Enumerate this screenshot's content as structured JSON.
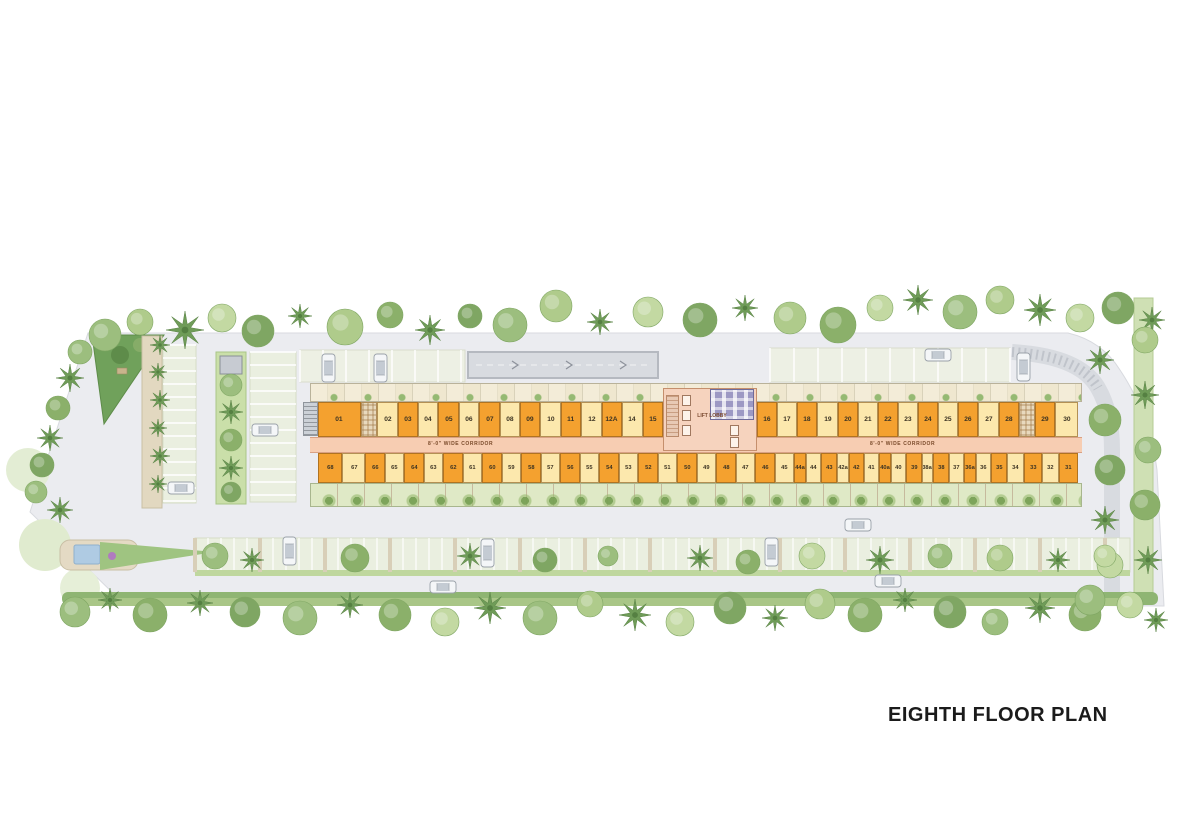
{
  "title": "EIGHTH FLOOR PLAN",
  "palette": {
    "unit_orange": "#f4a12f",
    "unit_cream": "#fce8ad",
    "corridor_pink": "#f7cdb2",
    "lobby_pink": "#f6d3be",
    "toilet_purple": "#9d99c4",
    "pavement_gray": "#ebecf0",
    "landscape_green": "#9cbe7e"
  },
  "building": {
    "corridor_label_left": "8'-0\" WIDE CORRIDOR",
    "corridor_label_right": "8'-0\" WIDE CORRIDOR",
    "lobby_label": "LIFT LOBBY",
    "top_left_units": [
      {
        "no": "01",
        "c": "o",
        "w": 2.2
      },
      {
        "t": "a"
      },
      {
        "no": "02",
        "c": "c"
      },
      {
        "no": "03",
        "c": "o"
      },
      {
        "no": "04",
        "c": "c"
      },
      {
        "no": "05",
        "c": "o"
      },
      {
        "no": "06",
        "c": "c"
      },
      {
        "no": "07",
        "c": "o"
      },
      {
        "no": "08",
        "c": "c"
      },
      {
        "no": "09",
        "c": "o"
      },
      {
        "no": "10",
        "c": "c"
      },
      {
        "no": "11",
        "c": "o"
      },
      {
        "no": "12",
        "c": "c"
      },
      {
        "no": "12A",
        "c": "o"
      },
      {
        "no": "14",
        "c": "c"
      },
      {
        "no": "15",
        "c": "o"
      }
    ],
    "top_right_units": [
      {
        "no": "16",
        "c": "o"
      },
      {
        "no": "17",
        "c": "c"
      },
      {
        "no": "18",
        "c": "o"
      },
      {
        "no": "19",
        "c": "c"
      },
      {
        "no": "20",
        "c": "o"
      },
      {
        "no": "21",
        "c": "c"
      },
      {
        "no": "22",
        "c": "o"
      },
      {
        "no": "23",
        "c": "c"
      },
      {
        "no": "24",
        "c": "o"
      },
      {
        "no": "25",
        "c": "c"
      },
      {
        "no": "26",
        "c": "o"
      },
      {
        "no": "27",
        "c": "c"
      },
      {
        "no": "28",
        "c": "o"
      },
      {
        "t": "a"
      },
      {
        "no": "29",
        "c": "o"
      },
      {
        "no": "30",
        "c": "c",
        "w": 1.15
      }
    ],
    "bottom_units": [
      {
        "no": "68",
        "c": "o",
        "w": 1.6
      },
      {
        "no": "67",
        "c": "c",
        "w": 1.5
      },
      {
        "no": "66",
        "c": "o",
        "w": 1.25
      },
      {
        "no": "65",
        "c": "c",
        "w": 1.25
      },
      {
        "no": "64",
        "c": "o",
        "w": 1.25
      },
      {
        "no": "63",
        "c": "c",
        "w": 1.25
      },
      {
        "no": "62",
        "c": "o",
        "w": 1.25
      },
      {
        "no": "61",
        "c": "c",
        "w": 1.25
      },
      {
        "no": "60",
        "c": "o",
        "w": 1.25
      },
      {
        "no": "59",
        "c": "c",
        "w": 1.25
      },
      {
        "no": "58",
        "c": "o",
        "w": 1.25
      },
      {
        "no": "57",
        "c": "c",
        "w": 1.25
      },
      {
        "no": "56",
        "c": "o",
        "w": 1.25
      },
      {
        "no": "55",
        "c": "c",
        "w": 1.25
      },
      {
        "no": "54",
        "c": "o",
        "w": 1.25
      },
      {
        "no": "53",
        "c": "c",
        "w": 1.25
      },
      {
        "no": "52",
        "c": "o",
        "w": 1.25
      },
      {
        "no": "51",
        "c": "c",
        "w": 1.25
      },
      {
        "no": "50",
        "c": "o",
        "w": 1.25
      },
      {
        "no": "49",
        "c": "c",
        "w": 1.25
      },
      {
        "no": "48",
        "c": "o",
        "w": 1.25
      },
      {
        "no": "47",
        "c": "c",
        "w": 1.25
      },
      {
        "no": "46",
        "c": "o",
        "w": 1.25
      },
      {
        "no": "45",
        "c": "c",
        "w": 1.25
      },
      {
        "no": "44a",
        "c": "o",
        "w": 0.7
      },
      {
        "no": "44",
        "c": "c",
        "w": 0.95
      },
      {
        "no": "43",
        "c": "o",
        "w": 0.95
      },
      {
        "no": "42a",
        "c": "c",
        "w": 0.7
      },
      {
        "no": "42",
        "c": "o",
        "w": 0.95
      },
      {
        "no": "41",
        "c": "c",
        "w": 0.95
      },
      {
        "no": "40a",
        "c": "o",
        "w": 0.7
      },
      {
        "no": "40",
        "c": "c",
        "w": 0.95
      },
      {
        "no": "39",
        "c": "o",
        "w": 0.95
      },
      {
        "no": "38a",
        "c": "c",
        "w": 0.7
      },
      {
        "no": "38",
        "c": "o",
        "w": 0.95
      },
      {
        "no": "37",
        "c": "c",
        "w": 0.95
      },
      {
        "no": "36a",
        "c": "o",
        "w": 0.7
      },
      {
        "no": "36",
        "c": "c",
        "w": 0.95
      },
      {
        "no": "35",
        "c": "o",
        "w": 1.0
      },
      {
        "no": "34",
        "c": "c",
        "w": 1.1
      },
      {
        "no": "33",
        "c": "o",
        "w": 1.1
      },
      {
        "no": "32",
        "c": "c",
        "w": 1.1
      },
      {
        "no": "31",
        "c": "o",
        "w": 1.2
      }
    ]
  },
  "site": {
    "cars": [
      {
        "x": 322,
        "y": 354,
        "dir": "v"
      },
      {
        "x": 374,
        "y": 354,
        "dir": "v"
      },
      {
        "x": 925,
        "y": 349,
        "dir": "h"
      },
      {
        "x": 1017,
        "y": 353,
        "dir": "v"
      },
      {
        "x": 168,
        "y": 482,
        "dir": "h"
      },
      {
        "x": 252,
        "y": 424,
        "dir": "h"
      },
      {
        "x": 283,
        "y": 537,
        "dir": "v"
      },
      {
        "x": 481,
        "y": 539,
        "dir": "v"
      },
      {
        "x": 765,
        "y": 538,
        "dir": "v"
      },
      {
        "x": 845,
        "y": 519,
        "dir": "h"
      },
      {
        "x": 430,
        "y": 581,
        "dir": "h"
      },
      {
        "x": 875,
        "y": 575,
        "dir": "h"
      }
    ]
  }
}
